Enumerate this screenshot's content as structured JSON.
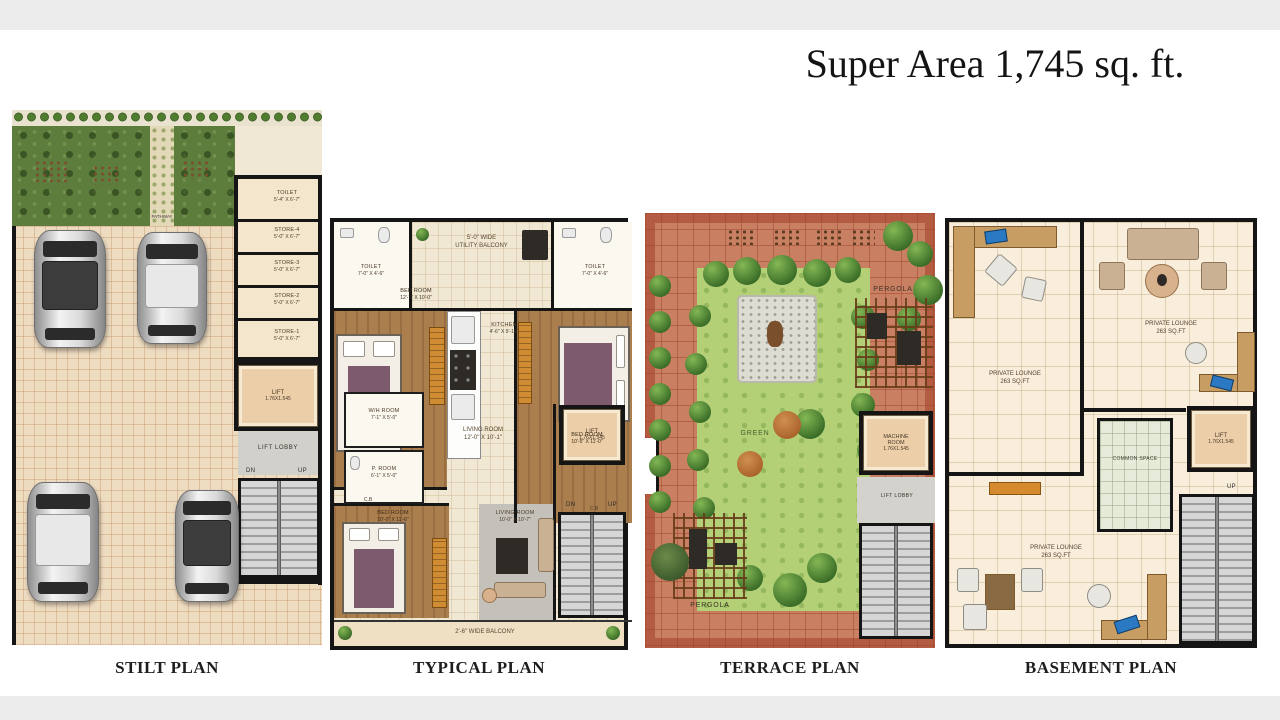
{
  "title": "Super Area 1,745 sq. ft.",
  "captions": {
    "stilt": "STILT PLAN",
    "typical": "TYPICAL PLAN",
    "terrace": "TERRACE PLAN",
    "basement": "BASEMENT PLAN"
  },
  "stilt": {
    "pathway": "PATHWAY",
    "toilet": {
      "name": "TOILET",
      "dims": "5'-4\" X 6'-7\""
    },
    "store4": {
      "name": "STORE-4",
      "dims": "5'-0\" X 6'-7\""
    },
    "store3": {
      "name": "STORE-3",
      "dims": "5'-0\" X 6'-7\""
    },
    "store2": {
      "name": "STORE-2",
      "dims": "5'-0\" X 6'-7\""
    },
    "store1": {
      "name": "STORE-1",
      "dims": "5'-0\" X 6'-7\""
    },
    "lift": {
      "name": "LIFT",
      "dims": "1.76X1.545"
    },
    "lift_lobby": "LIFT LOBBY",
    "dn": "DN",
    "up": "UP"
  },
  "typical": {
    "toilet_left": {
      "name": "TOILET",
      "dims": "7'-0\" X 4'-6\""
    },
    "utility_balcony": {
      "line1": "5'-0\" WIDE",
      "line2": "UTILITY BALCONY"
    },
    "toilet_right": {
      "name": "TOILET",
      "dims": "7'-0\" X 4'-6\""
    },
    "bedroom_left": {
      "name": "BED ROOM",
      "dims": "12'-7\" X 10'-0\""
    },
    "kitchen": {
      "name": "KITCHEN",
      "dims": "4'-6\" X 9'-10\""
    },
    "bedroom_right": {
      "name": "BED ROOM",
      "dims": "10'-5\" X 11'-0\""
    },
    "cb_left": "C.B",
    "cb_right": "C.B",
    "wh_room": {
      "name": "W/H ROOM",
      "dims": "7'-1\" X 5'-0\""
    },
    "p_room": {
      "name": "P. ROOM",
      "dims": "6'-1\" X 5'-0\""
    },
    "living_room": {
      "name": "LIVING ROOM",
      "dims": "12'-0\" X 10'-1\""
    },
    "bedroom_bottom": {
      "name": "BED ROOM",
      "dims": "10'-0\" X 11'-6\""
    },
    "living_room2": {
      "name": "LIVING ROOM",
      "dims": "10'-0\" X 10'-7\""
    },
    "lift": {
      "name": "LIFT",
      "dims": "1.76X1.545"
    },
    "dn": "DN",
    "up": "UP",
    "balcony": "2'-6\" WIDE BALCONY"
  },
  "terrace": {
    "pergola_top": "PERGOLA",
    "green": "GREEN",
    "machine_room": {
      "line1": "MACHINE",
      "line2": "ROOM",
      "dims": "1.76X1.545"
    },
    "lift_lobby": "LIFT LOBBY",
    "pergola_bottom": "PERGOLA"
  },
  "basement": {
    "lounge1": {
      "name": "PRIVATE LOUNGE",
      "dims": "263 SQ.FT"
    },
    "lounge2": {
      "name": "PRIVATE LOUNGE",
      "dims": "263 SQ.FT"
    },
    "lounge3": {
      "name": "PRIVATE LOUNGE",
      "dims": "263 SQ.FT"
    },
    "common_space": "COMMON SPACE",
    "lift": {
      "name": "LIFT",
      "dims": "1.76X1.545"
    },
    "up": "UP"
  },
  "colors": {
    "wall": "#151515",
    "lift_cabin": "#eccfa9",
    "lawn": "#b3d077",
    "terracotta": "#c97f61",
    "wood_floor": "#ab7e4e",
    "accent_wardrobe": "#cf8c33",
    "laptop_blue": "#2b79c2"
  }
}
